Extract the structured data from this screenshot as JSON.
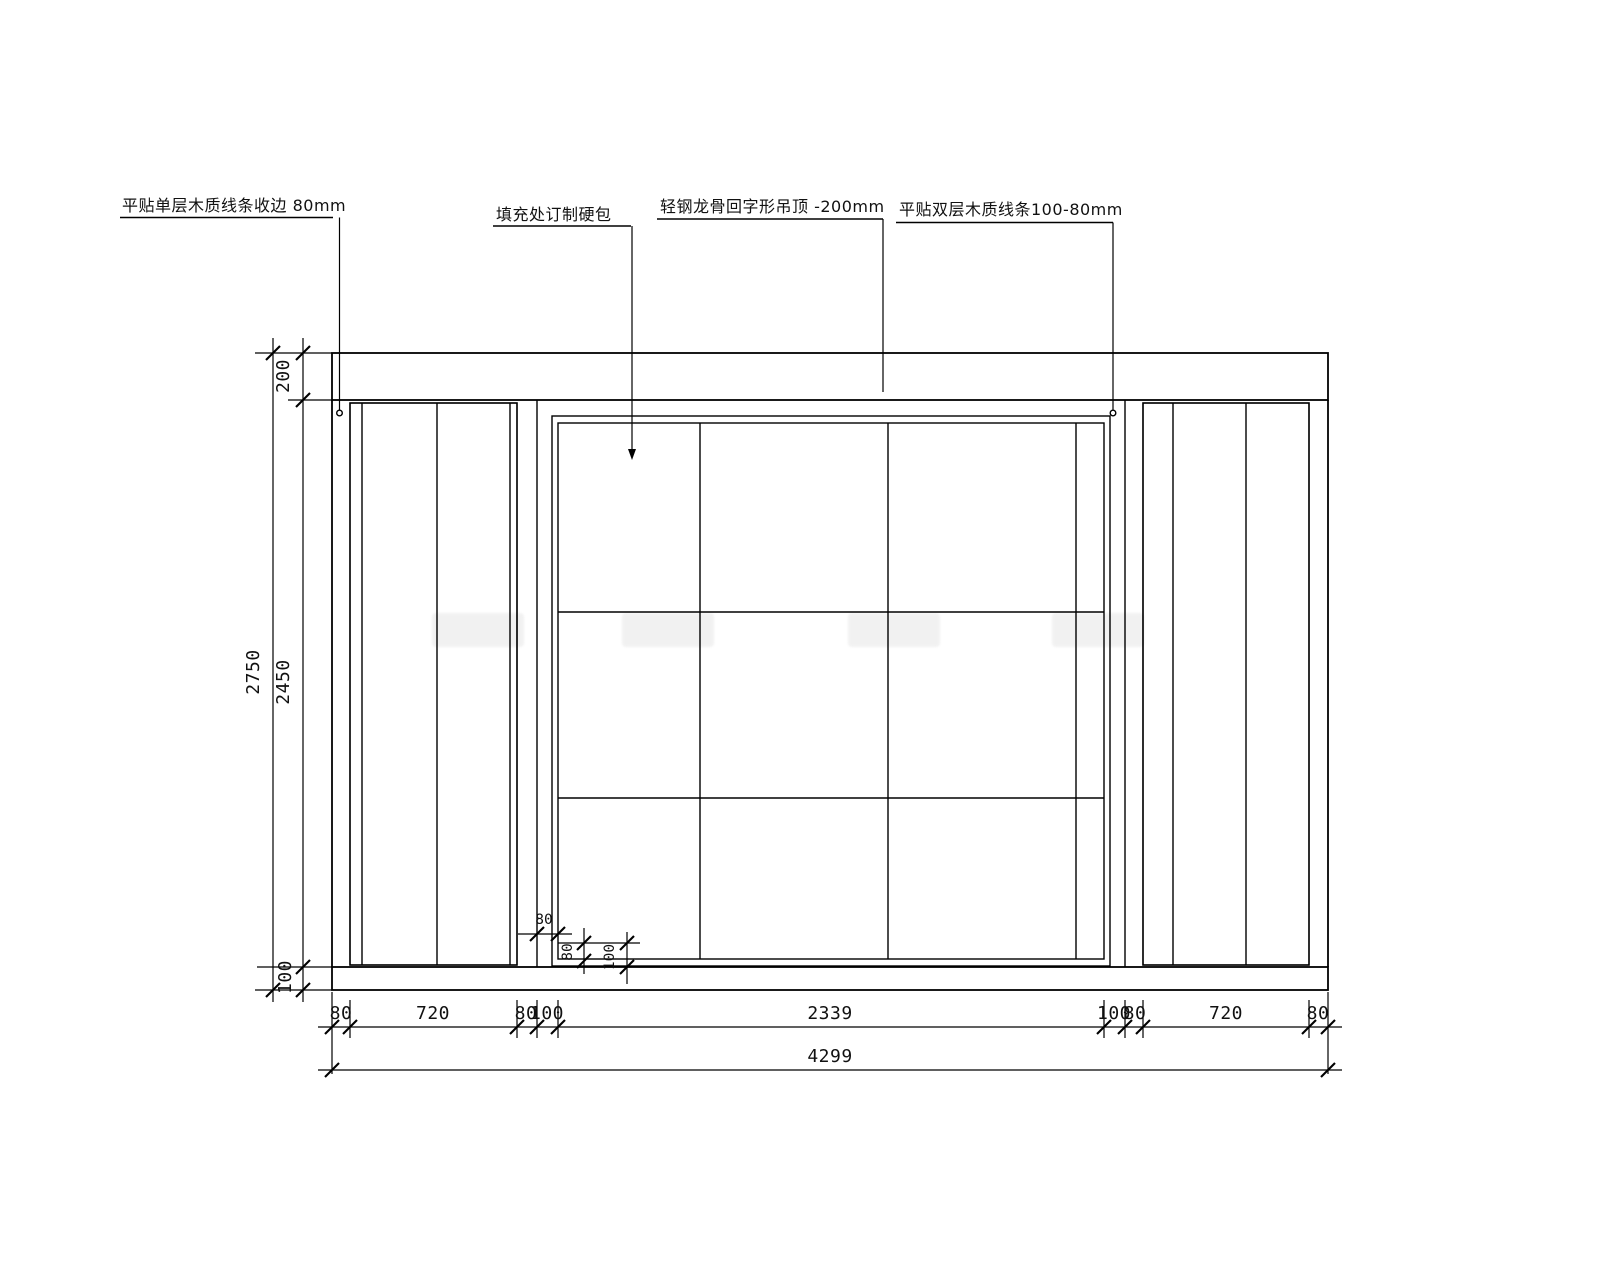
{
  "drawing_type": "interior-elevation-cad",
  "colors": {
    "background": "#ffffff",
    "line": "#000000"
  },
  "callouts": [
    {
      "id": "single-layer-wood-trim",
      "text": "平贴单层木质线条收边  80mm"
    },
    {
      "id": "custom-hard-pack-infill",
      "text": "填充处订制硬包"
    },
    {
      "id": "light-steel-keel-ceiling",
      "text": "轻钢龙骨回字形吊顶 -200mm"
    },
    {
      "id": "double-layer-wood-trim",
      "text": "平贴双层木质线条100-80mm"
    }
  ],
  "dimensions": {
    "vertical": {
      "overall": "2750",
      "top_drop": "200",
      "middle": "2450",
      "bottom": "100"
    },
    "bottom_row": [
      "80",
      "720",
      "80",
      "100",
      "2339",
      "100",
      "80",
      "720",
      "80"
    ],
    "total_width": "4299",
    "detail": {
      "h80": "80",
      "v80": "80",
      "v100": "100"
    }
  }
}
